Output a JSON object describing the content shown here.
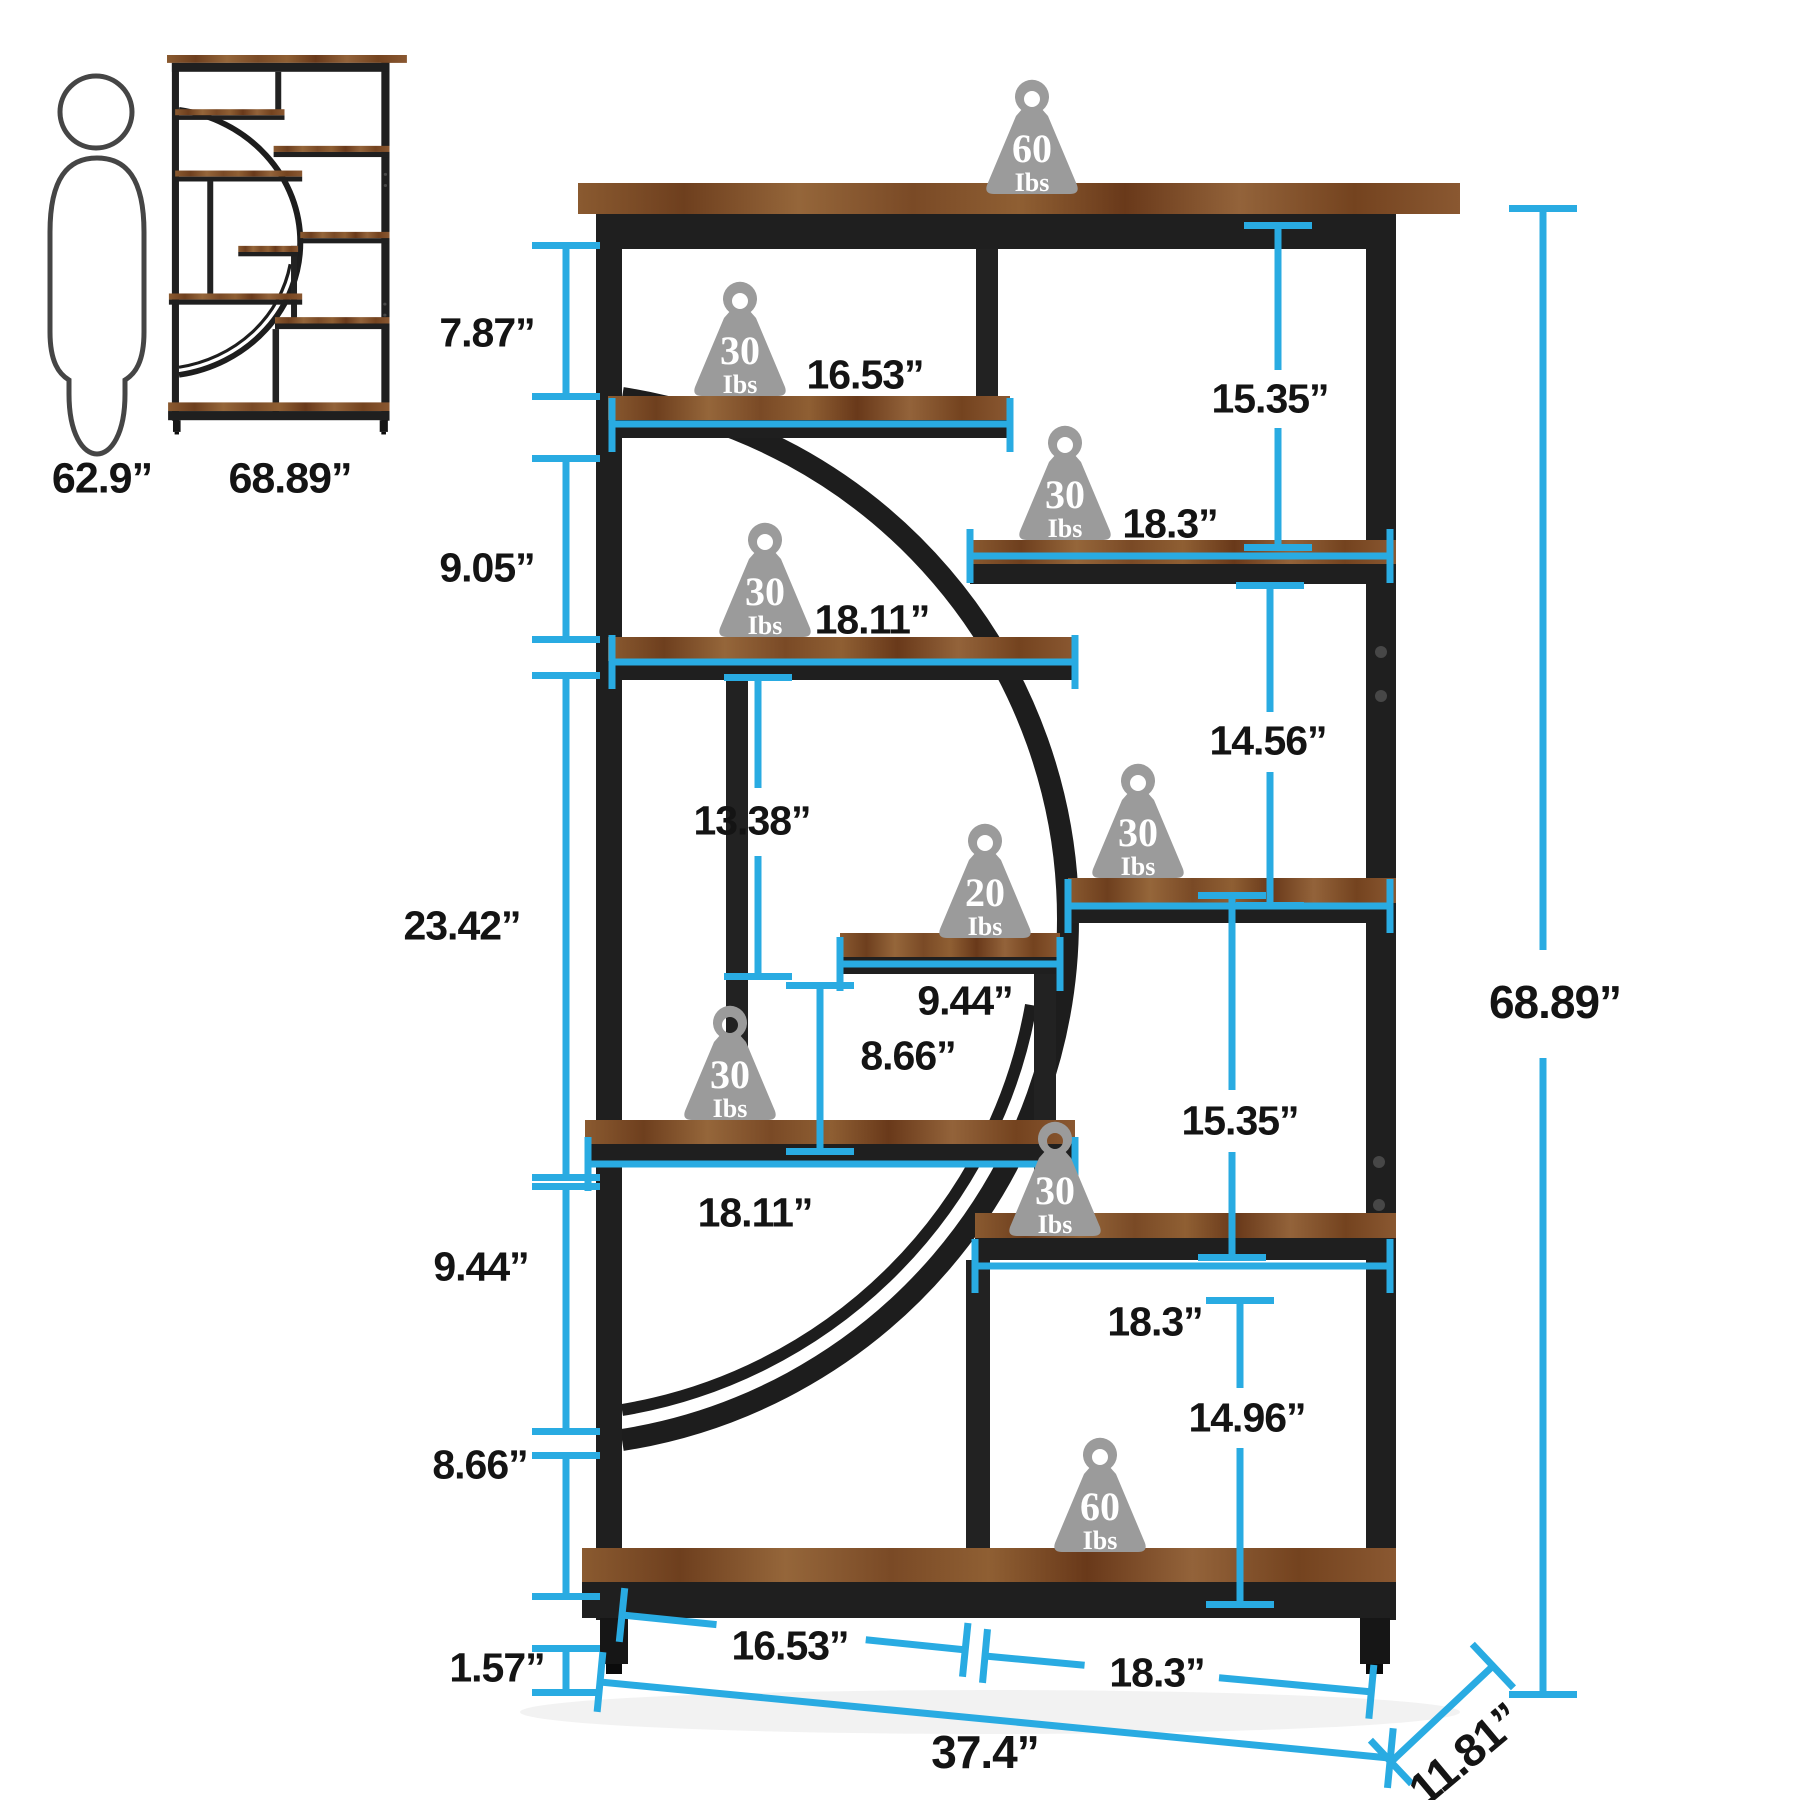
{
  "colors": {
    "accent": "#29abe2",
    "metal": "#1f1f1f",
    "wood": "#7b4a26",
    "weight_gray": "#9b9b9b"
  },
  "reference_figures": {
    "human_height": "62.9”",
    "thumbnail_height": "68.89”"
  },
  "overall": {
    "width": "37.4”",
    "depth": "11.81”",
    "height": "68.89”"
  },
  "heights_left": {
    "row1": "7.87”",
    "row2": "9.05”",
    "row3": "23.42”",
    "row4": "9.44”",
    "row5": "8.66”",
    "base": "1.57”"
  },
  "heights_right": {
    "top": "15.35”",
    "mid_upper": "14.56”",
    "mid_lower": "15.35”",
    "bottom": "14.96”"
  },
  "widths": {
    "shelf_a": "16.53”",
    "shelf_r1": "18.3”",
    "shelf_b": "18.11”",
    "shelf_small": "9.44”",
    "shelf_c": "18.11”",
    "shelf_r3": "18.3”",
    "bottom_left": "16.53”",
    "bottom_right": "18.3”"
  },
  "center_gaps": {
    "opening_height": "13.38”",
    "small_gap": "8.66”"
  },
  "weights": {
    "unit": "Ibs",
    "top": "60",
    "shelf_a": "30",
    "shelf_r1": "30",
    "shelf_b": "30",
    "shelf_r2": "30",
    "shelf_small": "20",
    "shelf_c": "30",
    "shelf_r3": "30",
    "bottom": "60"
  }
}
